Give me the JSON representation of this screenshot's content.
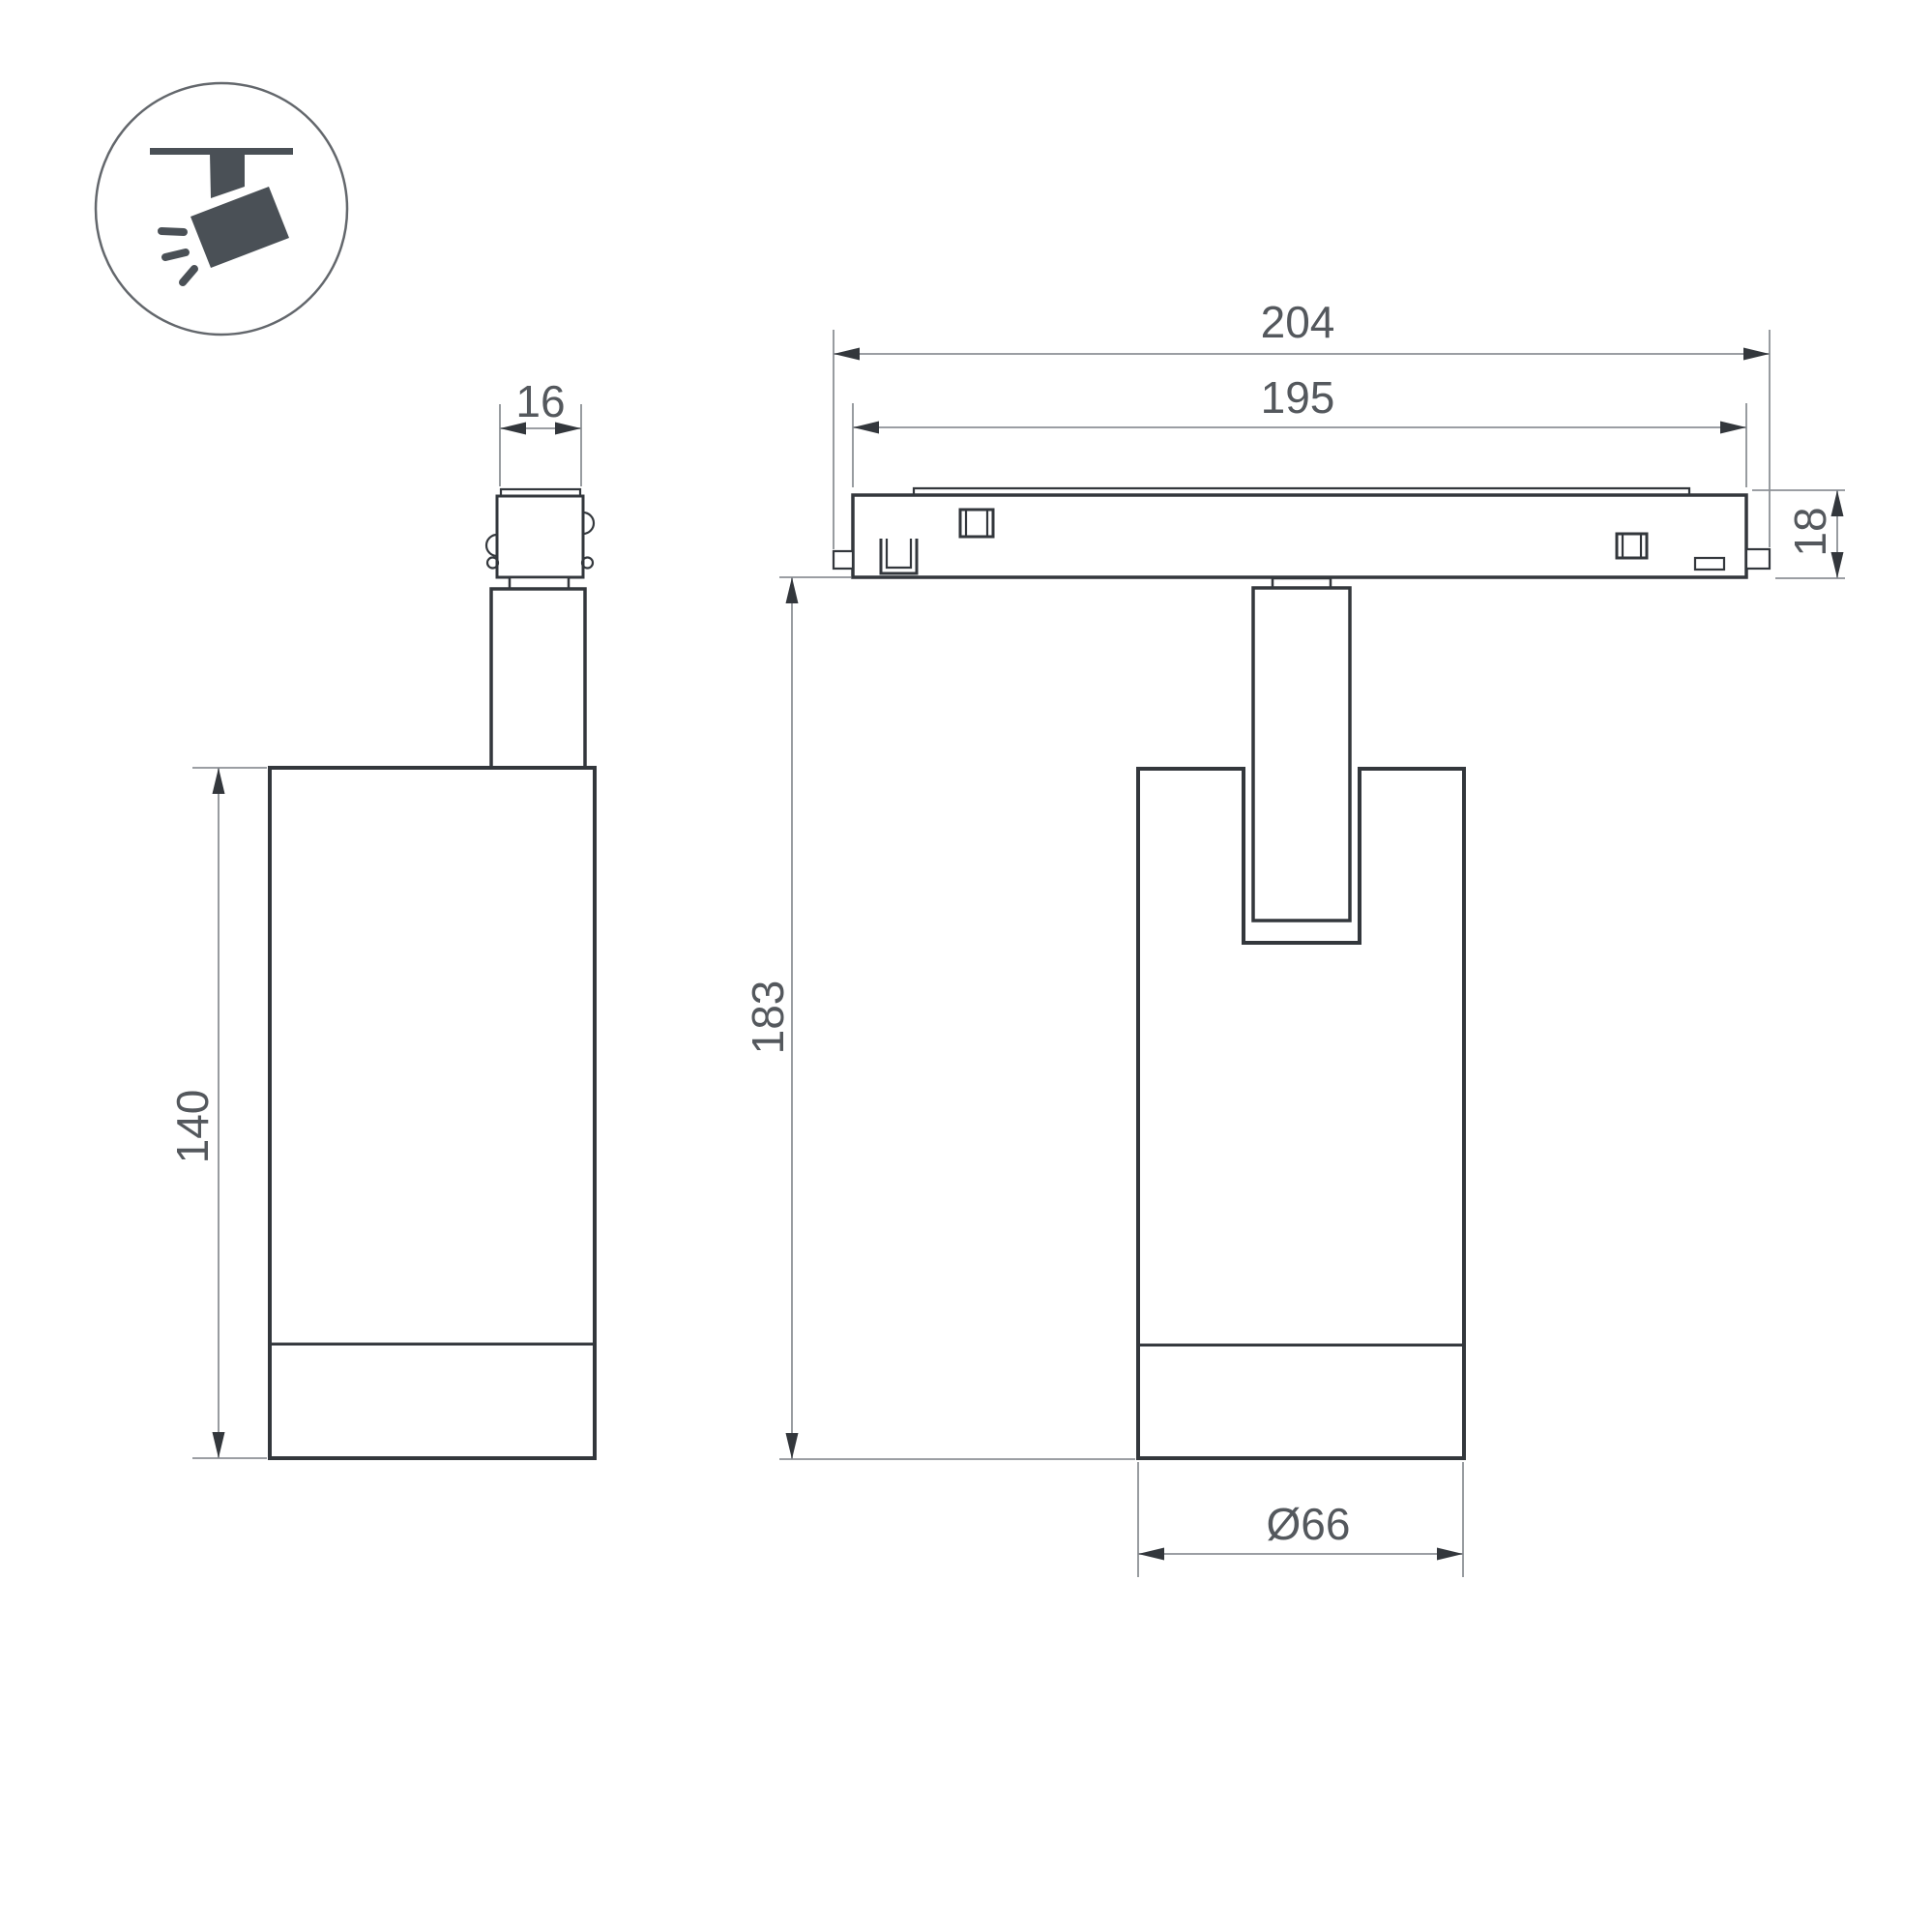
{
  "drawing": {
    "title": "track-spotlight-dimension-drawing",
    "dimensions": {
      "adapter_width": "16",
      "track_length_outer": "204",
      "track_length_body": "195",
      "track_height": "18",
      "body_height": "140",
      "total_height": "183",
      "body_diameter": "Ø66"
    },
    "icon": {
      "label": "ceiling-track-spotlight-pictogram"
    }
  },
  "colors": {
    "outline": "#33373c",
    "dimension_line": "#8d9196",
    "dimension_text": "#54585d",
    "icon_fill": "#4a5056",
    "background": "#ffffff"
  }
}
